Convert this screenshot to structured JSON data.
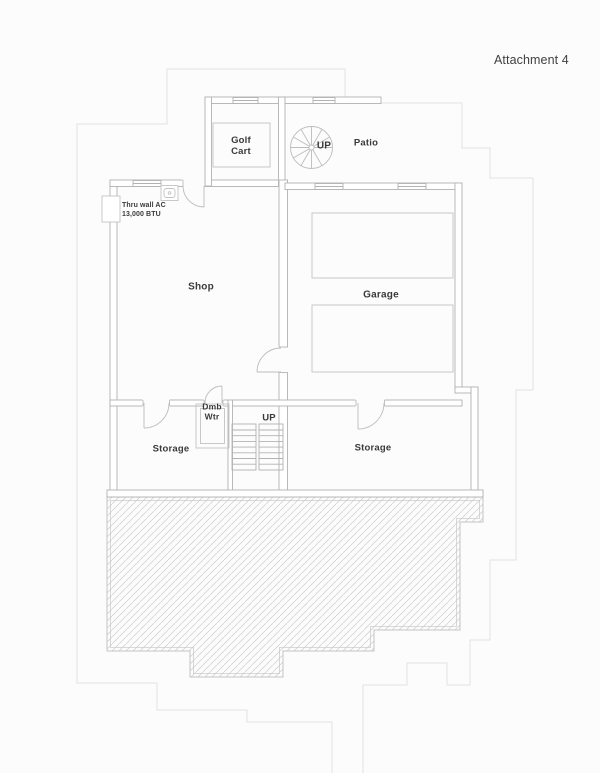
{
  "header": {
    "attachment_label": "Attachment 4"
  },
  "labels": {
    "golf_cart": "Golf\nCart",
    "patio": "Patio",
    "spiral_up": "UP",
    "shop": "Shop",
    "garage": "Garage",
    "dumbwaiter": "Dmb\nWtr",
    "stair_up": "UP",
    "storage_left": "Storage",
    "storage_right": "Storage",
    "ac_note": "Thru wall AC\n13,000 BTU"
  },
  "colors": {
    "background": "#fcfcfc",
    "wall_line": "#b2b2b2",
    "fixture_line": "#c2c2c2",
    "hatch_line": "#d4d4d4",
    "hatch_border": "#c4c4c4",
    "faint_site_outline": "#e0e3e0",
    "label_text": "#3a3a3a"
  }
}
